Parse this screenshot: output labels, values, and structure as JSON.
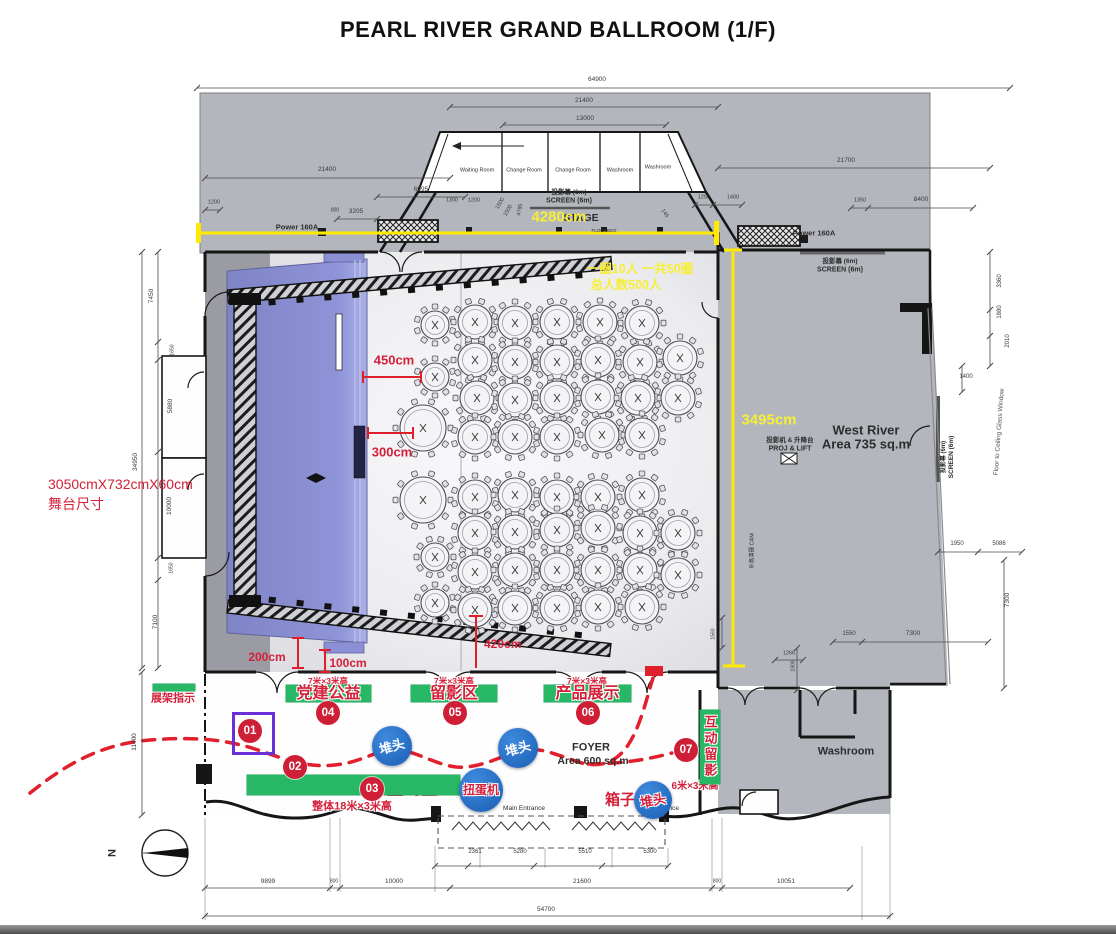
{
  "title": "PEARL RIVER GRAND BALLROOM (1/F)",
  "colors": {
    "accent_green": "#28b865",
    "accent_red": "#d4203a",
    "badge_red": "#cf1f36",
    "marker_blue": "#1f6fd0",
    "highlight_yellow": "#f6ef38",
    "stage_blue": "#8b90d5",
    "plan_gray": "#b4b6bd",
    "purple": "#6a2fd6"
  },
  "annotations": [
    {
      "id": "room-waiting",
      "t": "Waiting Room",
      "x": 477,
      "y": 171,
      "s": 5.5
    },
    {
      "id": "room-change-1",
      "t": "Change Room",
      "x": 524,
      "y": 171,
      "s": 5.5
    },
    {
      "id": "room-change-2",
      "t": "Change Room",
      "x": 573,
      "y": 171,
      "s": 5.5
    },
    {
      "id": "room-washroom-1",
      "t": "Washroom",
      "x": 620,
      "y": 171,
      "s": 5.5
    },
    {
      "id": "room-washroom-2",
      "t": "Washroom",
      "x": 658,
      "y": 168,
      "s": 5.5
    },
    {
      "id": "screen-top-cn",
      "t": "投影幕 (6m)",
      "x": 569,
      "y": 193,
      "s": 6.5,
      "w": 700
    },
    {
      "id": "screen-top-en",
      "t": "SCREEN (6m)",
      "x": 569,
      "y": 201,
      "s": 7,
      "w": 700
    },
    {
      "id": "stage-label",
      "t": "STAGE",
      "x": 581,
      "y": 218,
      "s": 10.5,
      "w": 700
    },
    {
      "id": "floorbox-label",
      "t": "FLOORBOX",
      "x": 604,
      "y": 231,
      "s": 4.5
    },
    {
      "id": "power-left",
      "t": "Power 160A",
      "x": 297,
      "y": 227,
      "s": 7.5,
      "w": 700
    },
    {
      "id": "power-right",
      "t": "Power 160A",
      "x": 814,
      "y": 233,
      "s": 7.5,
      "w": 700
    },
    {
      "id": "screen-right-cn",
      "t": "投影幕 (6m)",
      "x": 840,
      "y": 262,
      "s": 6.5,
      "w": 700
    },
    {
      "id": "screen-right-en",
      "t": "SCREEN (6m)",
      "x": 840,
      "y": 270,
      "s": 7,
      "w": 700
    },
    {
      "id": "west-river-name",
      "t": "West River",
      "x": 866,
      "y": 430,
      "s": 13,
      "w": 700
    },
    {
      "id": "west-river-area",
      "t": "Area 735 sq.m",
      "x": 866,
      "y": 444,
      "s": 13,
      "w": 700
    },
    {
      "id": "proj-lift-cn",
      "t": "投影机 & 升降台",
      "x": 790,
      "y": 441,
      "s": 6.5,
      "w": 700
    },
    {
      "id": "proj-lift-en",
      "t": "PROJ & LIFT",
      "x": 790,
      "y": 449,
      "s": 7,
      "w": 700
    },
    {
      "id": "camera-label",
      "t": "⊕高清摄 CAM",
      "x": 753,
      "y": 551,
      "s": 5.5,
      "r": -90
    },
    {
      "id": "screen-wall-cn",
      "t": "投影幕 (6m)",
      "x": 944,
      "y": 457,
      "s": 6,
      "w": 700,
      "r": -90
    },
    {
      "id": "screen-wall-en",
      "t": "SCREEN (6m)",
      "x": 952,
      "y": 457,
      "s": 6.5,
      "w": 700,
      "r": -90
    },
    {
      "id": "glass-window-label",
      "t": "Floor to Ceiling Glass Window",
      "x": 1000,
      "y": 432,
      "s": 6.5,
      "c": "#555",
      "r": -86
    },
    {
      "id": "washroom-label",
      "t": "Washroom",
      "x": 846,
      "y": 752,
      "s": 11,
      "w": 700
    },
    {
      "id": "foyer-name",
      "t": "FOYER",
      "x": 591,
      "y": 748,
      "s": 11,
      "w": 700
    },
    {
      "id": "foyer-area",
      "t": "Area 600 sq.m",
      "x": 593,
      "y": 761,
      "s": 10.5,
      "w": 700
    },
    {
      "id": "main-entrance-1",
      "t": "Main Entrance",
      "x": 524,
      "y": 809,
      "s": 6.5
    },
    {
      "id": "main-entrance-2",
      "t": "Main Entrance",
      "x": 658,
      "y": 809,
      "s": 6.5
    },
    {
      "id": "capacity-note-1",
      "t": "一圈10人 一共50圈",
      "x": 640,
      "y": 269,
      "s": 12.5,
      "w": 700,
      "c": "yellow"
    },
    {
      "id": "capacity-note-2",
      "t": "总人数500人",
      "x": 626,
      "y": 285,
      "s": 12.5,
      "w": 700,
      "c": "yellow"
    },
    {
      "id": "dim-4280cm",
      "t": "4280cm",
      "x": 559,
      "y": 217,
      "s": 15,
      "w": 700,
      "c": "yellow"
    },
    {
      "id": "dim-3495cm",
      "t": "3495cm",
      "x": 769,
      "y": 420,
      "s": 15,
      "w": 700,
      "c": "yellow"
    },
    {
      "id": "stage-size-1",
      "t": "3050cmX732cmX60cm",
      "x": 48,
      "y": 484,
      "s": 14,
      "c": "red",
      "a": "l"
    },
    {
      "id": "stage-size-2",
      "t": "舞台尺寸",
      "x": 48,
      "y": 504,
      "s": 14,
      "c": "red",
      "a": "l"
    },
    {
      "id": "dim-450cm",
      "t": "450cm",
      "x": 394,
      "y": 360,
      "s": 13,
      "w": 700,
      "c": "red"
    },
    {
      "id": "dim-300cm",
      "t": "300cm",
      "x": 392,
      "y": 452,
      "s": 13,
      "w": 700,
      "c": "red"
    },
    {
      "id": "dim-200cm",
      "t": "200cm",
      "x": 267,
      "y": 657,
      "s": 12,
      "w": 700,
      "c": "red"
    },
    {
      "id": "dim-100cm",
      "t": "100cm",
      "x": 348,
      "y": 663,
      "s": 12,
      "w": 700,
      "c": "red"
    },
    {
      "id": "dim-420cm",
      "t": "420cm",
      "x": 484,
      "y": 644,
      "s": 12,
      "w": 700,
      "c": "red",
      "a": "l"
    },
    {
      "id": "rack-sign-label",
      "t": "展架指示",
      "x": 173,
      "y": 699,
      "s": 11,
      "w": 700,
      "c": "red"
    },
    {
      "id": "banner-height-1",
      "t": "7米×3米高",
      "x": 328,
      "y": 681,
      "s": 8.5,
      "w": 700,
      "c": "red",
      "h": 1
    },
    {
      "id": "banner-height-2",
      "t": "7米×3米高",
      "x": 454,
      "y": 681,
      "s": 8.5,
      "w": 700,
      "c": "red",
      "h": 1
    },
    {
      "id": "banner-height-3",
      "t": "7米×3米高",
      "x": 587,
      "y": 681,
      "s": 8.5,
      "w": 700,
      "c": "red",
      "h": 1
    },
    {
      "id": "welcome-desk-label",
      "t": "迎宾台",
      "x": 291,
      "y": 786,
      "s": 16,
      "w": 700,
      "c": "red",
      "h": 1
    },
    {
      "id": "signin-area-label",
      "t": "签到区",
      "x": 412,
      "y": 789,
      "s": 17,
      "w": 700,
      "c": "red",
      "h": 1
    },
    {
      "id": "welcome-height-note",
      "t": "整体18米×3米高",
      "x": 352,
      "y": 807,
      "s": 11,
      "w": 700,
      "c": "red",
      "h": 1
    },
    {
      "id": "interactive-height-note",
      "t": "6米×3米高",
      "x": 695,
      "y": 787,
      "s": 10,
      "w": 700,
      "c": "red",
      "h": 1
    },
    {
      "id": "box-label",
      "t": "箱子",
      "x": 620,
      "y": 800,
      "s": 15,
      "w": 700,
      "c": "red",
      "h": 1
    },
    {
      "id": "north-label",
      "t": "N",
      "x": 113,
      "y": 853,
      "s": 11,
      "w": 700,
      "r": -90
    }
  ],
  "dim_labels": [
    {
      "t": "64900",
      "x": 597,
      "y": 80
    },
    {
      "t": "21400",
      "x": 584,
      "y": 101
    },
    {
      "t": "13000",
      "x": 585,
      "y": 119
    },
    {
      "t": "21400",
      "x": 327,
      "y": 170
    },
    {
      "t": "6995",
      "x": 421,
      "y": 190
    },
    {
      "t": "3205",
      "x": 356,
      "y": 212
    },
    {
      "t": "1200",
      "x": 214,
      "y": 203,
      "s": 5.5
    },
    {
      "t": "800",
      "x": 335,
      "y": 211,
      "s": 5
    },
    {
      "t": "1300",
      "x": 452,
      "y": 201,
      "s": 5.5
    },
    {
      "t": "1200",
      "x": 474,
      "y": 201,
      "s": 5.5
    },
    {
      "t": "1500",
      "x": 501,
      "y": 204,
      "r": -60,
      "s": 5.5
    },
    {
      "t": "1500",
      "x": 509,
      "y": 211,
      "r": -60,
      "s": 5.5
    },
    {
      "t": "4795",
      "x": 521,
      "y": 210,
      "r": -78,
      "s": 5.5
    },
    {
      "t": "145",
      "x": 664,
      "y": 214,
      "r": 55,
      "s": 5.5
    },
    {
      "t": "21700",
      "x": 846,
      "y": 161
    },
    {
      "t": "1250",
      "x": 704,
      "y": 198,
      "s": 5.5
    },
    {
      "t": "1400",
      "x": 733,
      "y": 198,
      "s": 5.5
    },
    {
      "t": "1350",
      "x": 860,
      "y": 201,
      "s": 5.5
    },
    {
      "t": "8400",
      "x": 921,
      "y": 200
    },
    {
      "t": "3360",
      "x": 1000,
      "y": 281,
      "r": -90,
      "s": 6
    },
    {
      "t": "1880",
      "x": 1000,
      "y": 312,
      "r": -90,
      "s": 6
    },
    {
      "t": "2010",
      "x": 1008,
      "y": 341,
      "r": -90,
      "s": 6
    },
    {
      "t": "1400",
      "x": 966,
      "y": 377,
      "s": 6
    },
    {
      "t": "1950",
      "x": 957,
      "y": 544,
      "s": 6
    },
    {
      "t": "5086",
      "x": 999,
      "y": 544,
      "s": 6
    },
    {
      "t": "7300",
      "x": 1008,
      "y": 600,
      "r": -90
    },
    {
      "t": "1550",
      "x": 849,
      "y": 634,
      "s": 6
    },
    {
      "t": "7300",
      "x": 913,
      "y": 634
    },
    {
      "t": "1560",
      "x": 714,
      "y": 634,
      "r": -90,
      "s": 5
    },
    {
      "t": "1266",
      "x": 789,
      "y": 654,
      "s": 5.5
    },
    {
      "t": "1900",
      "x": 794,
      "y": 666,
      "r": -90,
      "s": 5
    },
    {
      "t": "7450",
      "x": 152,
      "y": 296,
      "r": -90
    },
    {
      "t": "1650",
      "x": 173,
      "y": 350,
      "r": -90,
      "s": 5
    },
    {
      "t": "5880",
      "x": 171,
      "y": 406,
      "r": -90
    },
    {
      "t": "34950",
      "x": 136,
      "y": 462,
      "r": -90
    },
    {
      "t": "10000",
      "x": 170,
      "y": 506,
      "r": -90
    },
    {
      "t": "1650",
      "x": 172,
      "y": 568,
      "r": -90,
      "s": 5
    },
    {
      "t": "7100",
      "x": 156,
      "y": 622,
      "r": -90
    },
    {
      "t": "11400",
      "x": 135,
      "y": 742,
      "r": -90
    },
    {
      "t": "2361",
      "x": 475,
      "y": 852,
      "s": 6
    },
    {
      "t": "5280",
      "x": 520,
      "y": 852,
      "s": 6
    },
    {
      "t": "5510",
      "x": 585,
      "y": 852,
      "s": 6
    },
    {
      "t": "5300",
      "x": 650,
      "y": 852,
      "s": 6
    },
    {
      "t": "9899",
      "x": 268,
      "y": 882
    },
    {
      "t": "800",
      "x": 334,
      "y": 882,
      "s": 5
    },
    {
      "t": "10000",
      "x": 394,
      "y": 882
    },
    {
      "t": "21600",
      "x": 582,
      "y": 882
    },
    {
      "t": "800",
      "x": 717,
      "y": 882,
      "s": 5
    },
    {
      "t": "10051",
      "x": 786,
      "y": 882
    },
    {
      "t": "54700",
      "x": 546,
      "y": 910
    }
  ],
  "dim_chains": {
    "h": [
      {
        "y": 88,
        "xs": [
          197,
          1010
        ]
      },
      {
        "y": 107,
        "xs": [
          450,
          718
        ]
      },
      {
        "y": 125,
        "xs": [
          503,
          666
        ]
      },
      {
        "y": 178,
        "xs": [
          205,
          450
        ]
      },
      {
        "y": 197,
        "xs": [
          377,
          465
        ]
      },
      {
        "y": 219,
        "xs": [
          337,
          377
        ]
      },
      {
        "y": 210,
        "xs": [
          205,
          220
        ]
      },
      {
        "y": 168,
        "xs": [
          718,
          990
        ]
      },
      {
        "y": 205,
        "xs": [
          695,
          713,
          742
        ]
      },
      {
        "y": 208,
        "xs": [
          851,
          868,
          973
        ]
      },
      {
        "y": 552,
        "xs": [
          938,
          978,
          1022
        ]
      },
      {
        "y": 642,
        "xs": [
          833,
          862,
          988
        ]
      },
      {
        "y": 660,
        "xs": [
          775,
          803
        ]
      },
      {
        "y": 866,
        "xs": [
          435,
          468,
          534,
          602,
          668
        ]
      },
      {
        "y": 888,
        "xs": [
          205,
          330,
          340,
          450,
          712,
          722,
          850
        ]
      },
      {
        "y": 916,
        "xs": [
          205,
          890
        ]
      }
    ],
    "v": [
      {
        "x": 158,
        "ys": [
          252,
          342,
          360,
          452,
          558,
          580,
          668
        ]
      },
      {
        "x": 142,
        "ys": [
          252,
          668
        ]
      },
      {
        "x": 142,
        "ys": [
          672,
          815
        ]
      },
      {
        "x": 990,
        "ys": [
          252,
          310,
          336,
          366
        ]
      },
      {
        "x": 962,
        "ys": [
          366,
          392
        ]
      },
      {
        "x": 1004,
        "ys": [
          560,
          688
        ]
      },
      {
        "x": 722,
        "ys": [
          618,
          648
        ]
      },
      {
        "x": 797,
        "ys": [
          648,
          690
        ]
      }
    ]
  },
  "banners": [
    {
      "id": "banner-rack-sign",
      "x": 153,
      "y": 684,
      "w": 42,
      "h": 7,
      "label": "",
      "fs": 9
    },
    {
      "id": "banner-party-charity",
      "x": 286,
      "y": 685,
      "w": 85,
      "h": 17,
      "label": "党建公益",
      "fs": 16
    },
    {
      "id": "banner-photo-zone",
      "x": 411,
      "y": 685,
      "w": 86,
      "h": 17,
      "label": "留影区",
      "fs": 16
    },
    {
      "id": "banner-product-display",
      "x": 544,
      "y": 685,
      "w": 87,
      "h": 17,
      "label": "产品展示",
      "fs": 16
    },
    {
      "id": "banner-welcome-signin",
      "x": 247,
      "y": 775,
      "w": 213,
      "h": 20,
      "label": "",
      "fs": 16
    },
    {
      "id": "banner-interactive-photo",
      "x": 700,
      "y": 710,
      "w": 20,
      "h": 74,
      "label": "互动留影",
      "fs": 13,
      "vertical": true
    }
  ],
  "badges": [
    {
      "n": "01",
      "x": 250,
      "y": 731
    },
    {
      "n": "02",
      "x": 295,
      "y": 767
    },
    {
      "n": "03",
      "x": 372,
      "y": 789
    },
    {
      "n": "04",
      "x": 328,
      "y": 713
    },
    {
      "n": "05",
      "x": 455,
      "y": 713
    },
    {
      "n": "06",
      "x": 588,
      "y": 713
    },
    {
      "n": "07",
      "x": 686,
      "y": 750
    }
  ],
  "purple_box": {
    "x": 232,
    "y": 712,
    "w": 37,
    "h": 37
  },
  "blue_markers": [
    {
      "t": "堆头",
      "x": 392,
      "y": 746,
      "r": 20,
      "style": "white",
      "rot": -15
    },
    {
      "t": "堆头",
      "x": 518,
      "y": 748,
      "r": 20,
      "style": "white",
      "rot": -15
    },
    {
      "t": "扭蛋机",
      "x": 481,
      "y": 790,
      "r": 22,
      "style": "red",
      "rot": 0
    },
    {
      "t": "堆头",
      "x": 653,
      "y": 800,
      "r": 19,
      "style": "red",
      "rot": -10
    }
  ],
  "tables": {
    "count": 50,
    "seats_per_table": 10,
    "positions": [
      [
        435,
        325,
        14
      ],
      [
        475,
        322,
        17
      ],
      [
        515,
        323,
        17
      ],
      [
        557,
        322,
        17
      ],
      [
        600,
        322,
        17
      ],
      [
        642,
        323,
        17
      ],
      [
        435,
        377,
        14
      ],
      [
        475,
        360,
        17
      ],
      [
        515,
        362,
        17
      ],
      [
        557,
        362,
        17
      ],
      [
        598,
        360,
        17
      ],
      [
        640,
        362,
        17
      ],
      [
        680,
        358,
        17
      ],
      [
        477,
        398,
        17
      ],
      [
        515,
        400,
        17
      ],
      [
        557,
        398,
        17
      ],
      [
        598,
        397,
        17
      ],
      [
        638,
        398,
        17
      ],
      [
        678,
        398,
        17
      ],
      [
        423,
        428,
        23
      ],
      [
        475,
        437,
        17
      ],
      [
        515,
        437,
        17
      ],
      [
        557,
        437,
        17
      ],
      [
        602,
        435,
        17
      ],
      [
        642,
        435,
        17
      ],
      [
        423,
        500,
        23
      ],
      [
        475,
        497,
        17
      ],
      [
        515,
        495,
        17
      ],
      [
        557,
        497,
        17
      ],
      [
        598,
        497,
        17
      ],
      [
        642,
        495,
        17
      ],
      [
        435,
        557,
        14
      ],
      [
        475,
        533,
        17
      ],
      [
        515,
        532,
        17
      ],
      [
        557,
        530,
        17
      ],
      [
        598,
        528,
        17
      ],
      [
        640,
        533,
        17
      ],
      [
        678,
        533,
        17
      ],
      [
        475,
        572,
        17
      ],
      [
        515,
        570,
        17
      ],
      [
        557,
        570,
        17
      ],
      [
        598,
        570,
        17
      ],
      [
        640,
        570,
        17
      ],
      [
        678,
        575,
        17
      ],
      [
        435,
        603,
        14
      ],
      [
        475,
        610,
        17
      ],
      [
        515,
        608,
        17
      ],
      [
        557,
        608,
        17
      ],
      [
        598,
        607,
        17
      ],
      [
        642,
        607,
        17
      ]
    ]
  }
}
